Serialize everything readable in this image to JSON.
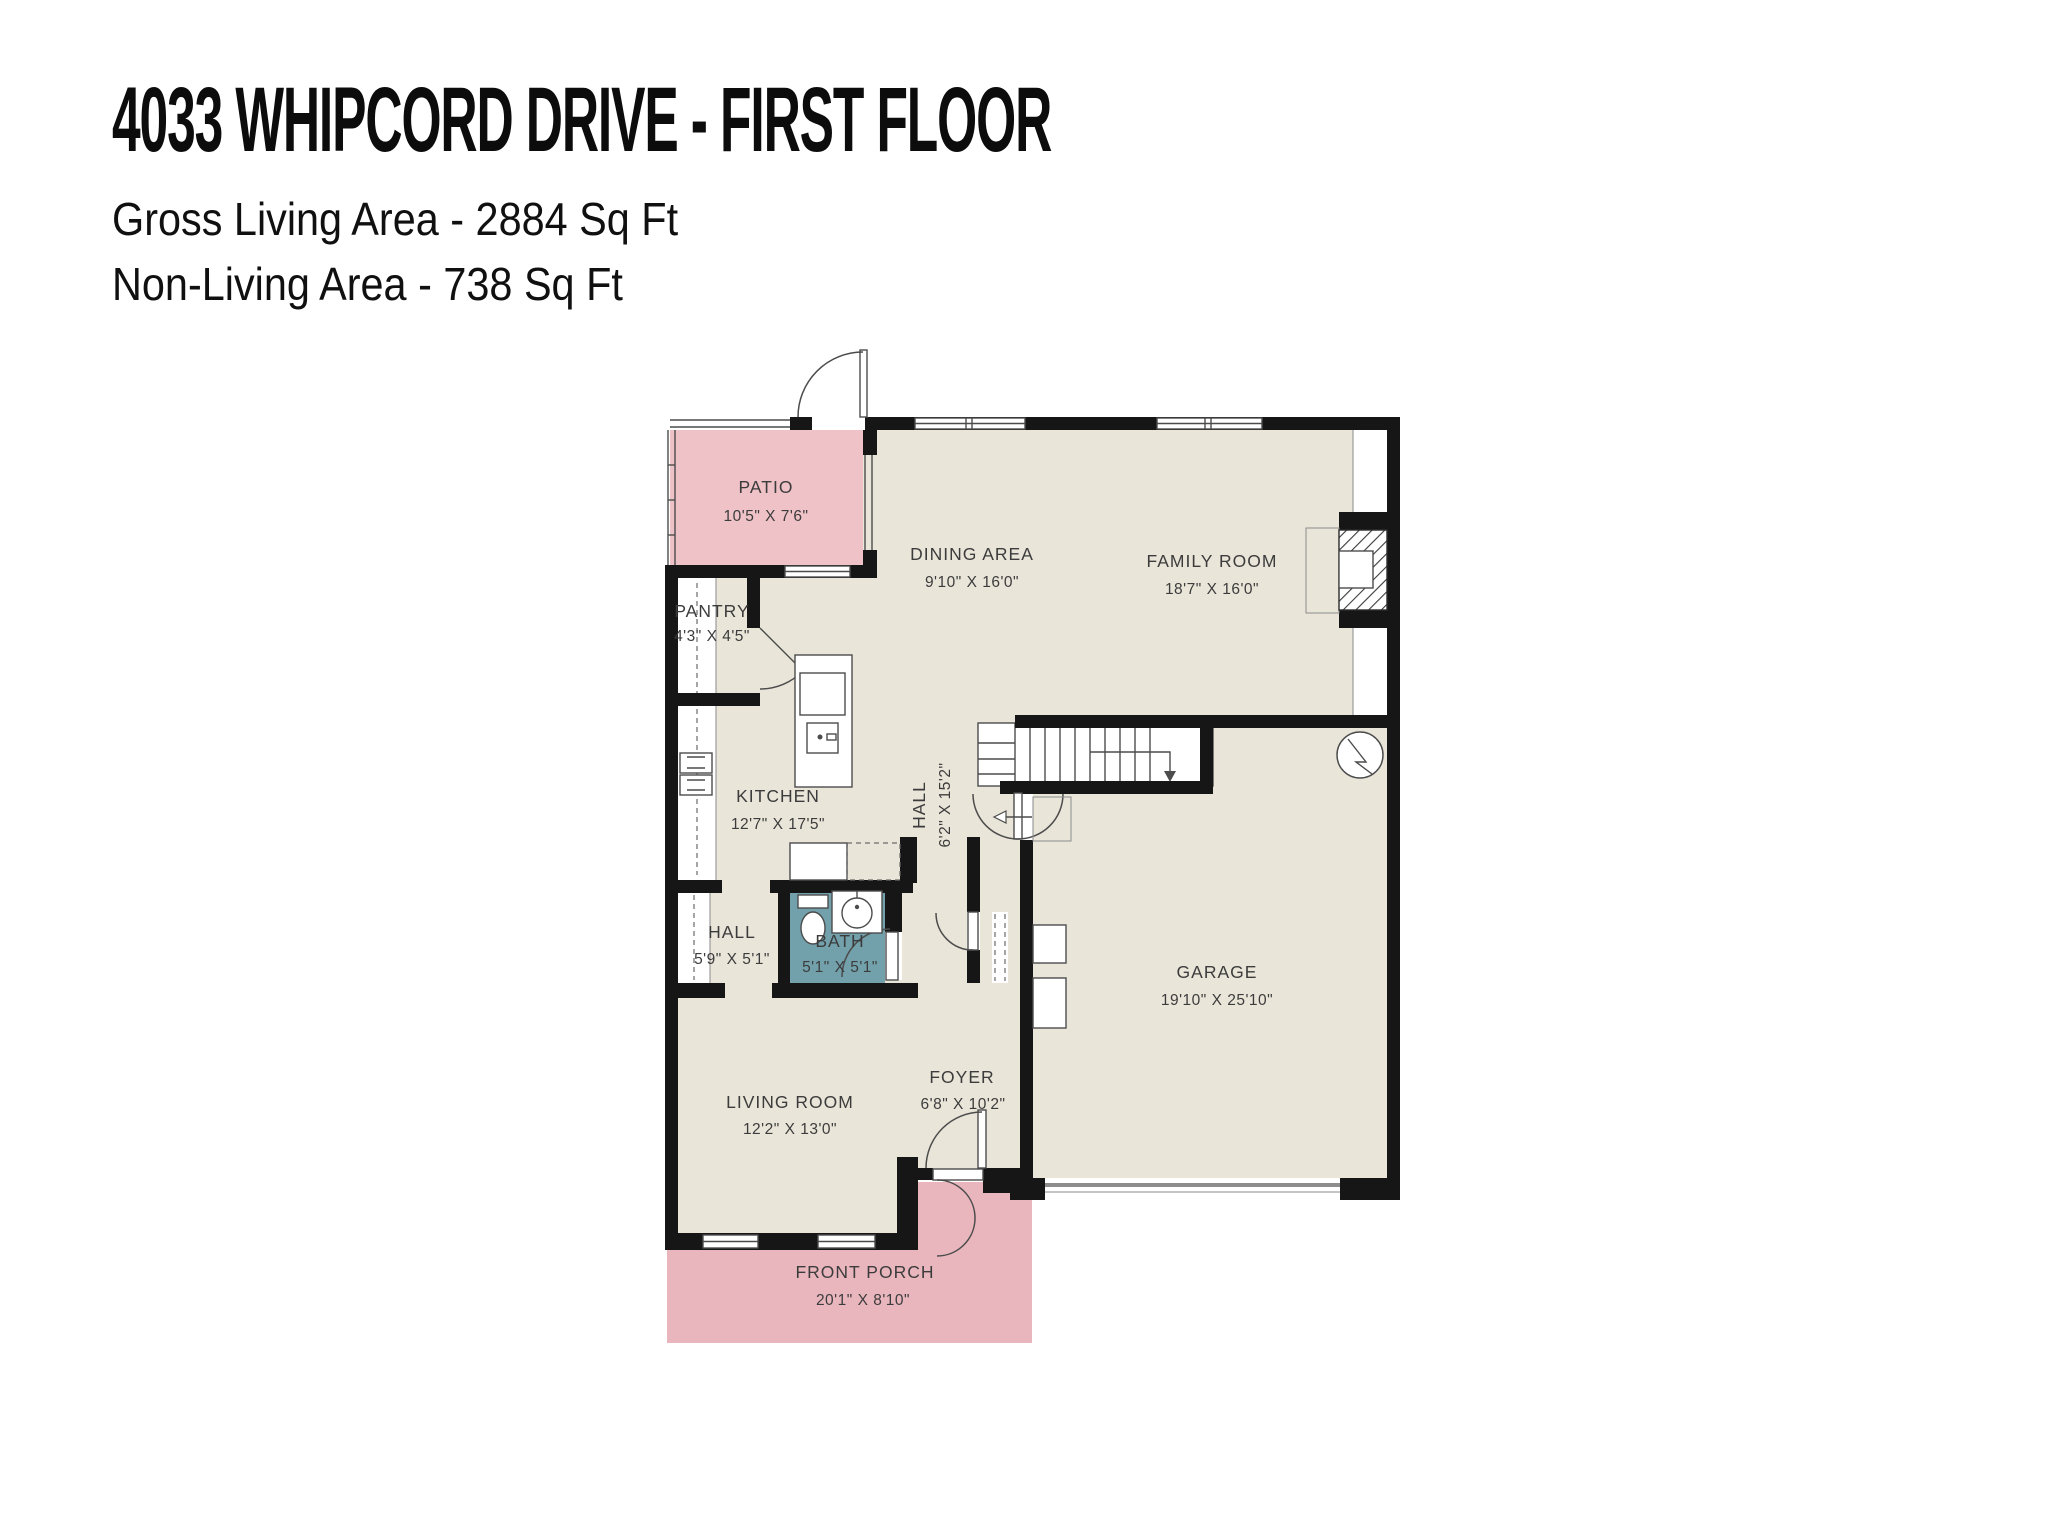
{
  "header": {
    "title": "4033 WHIPCORD DRIVE - FIRST FLOOR",
    "line1": "Gross Living Area - 2884 Sq Ft",
    "line2": "Non-Living Area - 738 Sq Ft"
  },
  "colors": {
    "wall": "#161616",
    "beige": "#e9e5d9",
    "pink": "#eec2c7",
    "pink2": "#e9b6bd",
    "teal": "#72a1ac",
    "label": "#3c3c3c"
  },
  "rooms": [
    {
      "id": "patio",
      "name": "PATIO",
      "dims": "10'5\" X 7'6\""
    },
    {
      "id": "dining-area",
      "name": "DINING AREA",
      "dims": "9'10\" X 16'0\""
    },
    {
      "id": "family-room",
      "name": "FAMILY ROOM",
      "dims": "18'7\" X 16'0\""
    },
    {
      "id": "pantry",
      "name": "PANTRY",
      "dims": "4'3\" X 4'5\""
    },
    {
      "id": "kitchen",
      "name": "KITCHEN",
      "dims": "12'7\" X 17'5\""
    },
    {
      "id": "hall-corridor",
      "name": "HALL",
      "dims": "6'2\" X 15'2\""
    },
    {
      "id": "hall",
      "name": "HALL",
      "dims": "5'9\" X 5'1\""
    },
    {
      "id": "bath",
      "name": "BATH",
      "dims": "5'1\" X 5'1\""
    },
    {
      "id": "garage",
      "name": "GARAGE",
      "dims": "19'10\" X 25'10\""
    },
    {
      "id": "living-room",
      "name": "LIVING ROOM",
      "dims": "12'2\" X 13'0\""
    },
    {
      "id": "foyer",
      "name": "FOYER",
      "dims": "6'8\" X 10'2\""
    },
    {
      "id": "front-porch",
      "name": "FRONT PORCH",
      "dims": "20'1\" X 8'10\""
    }
  ]
}
